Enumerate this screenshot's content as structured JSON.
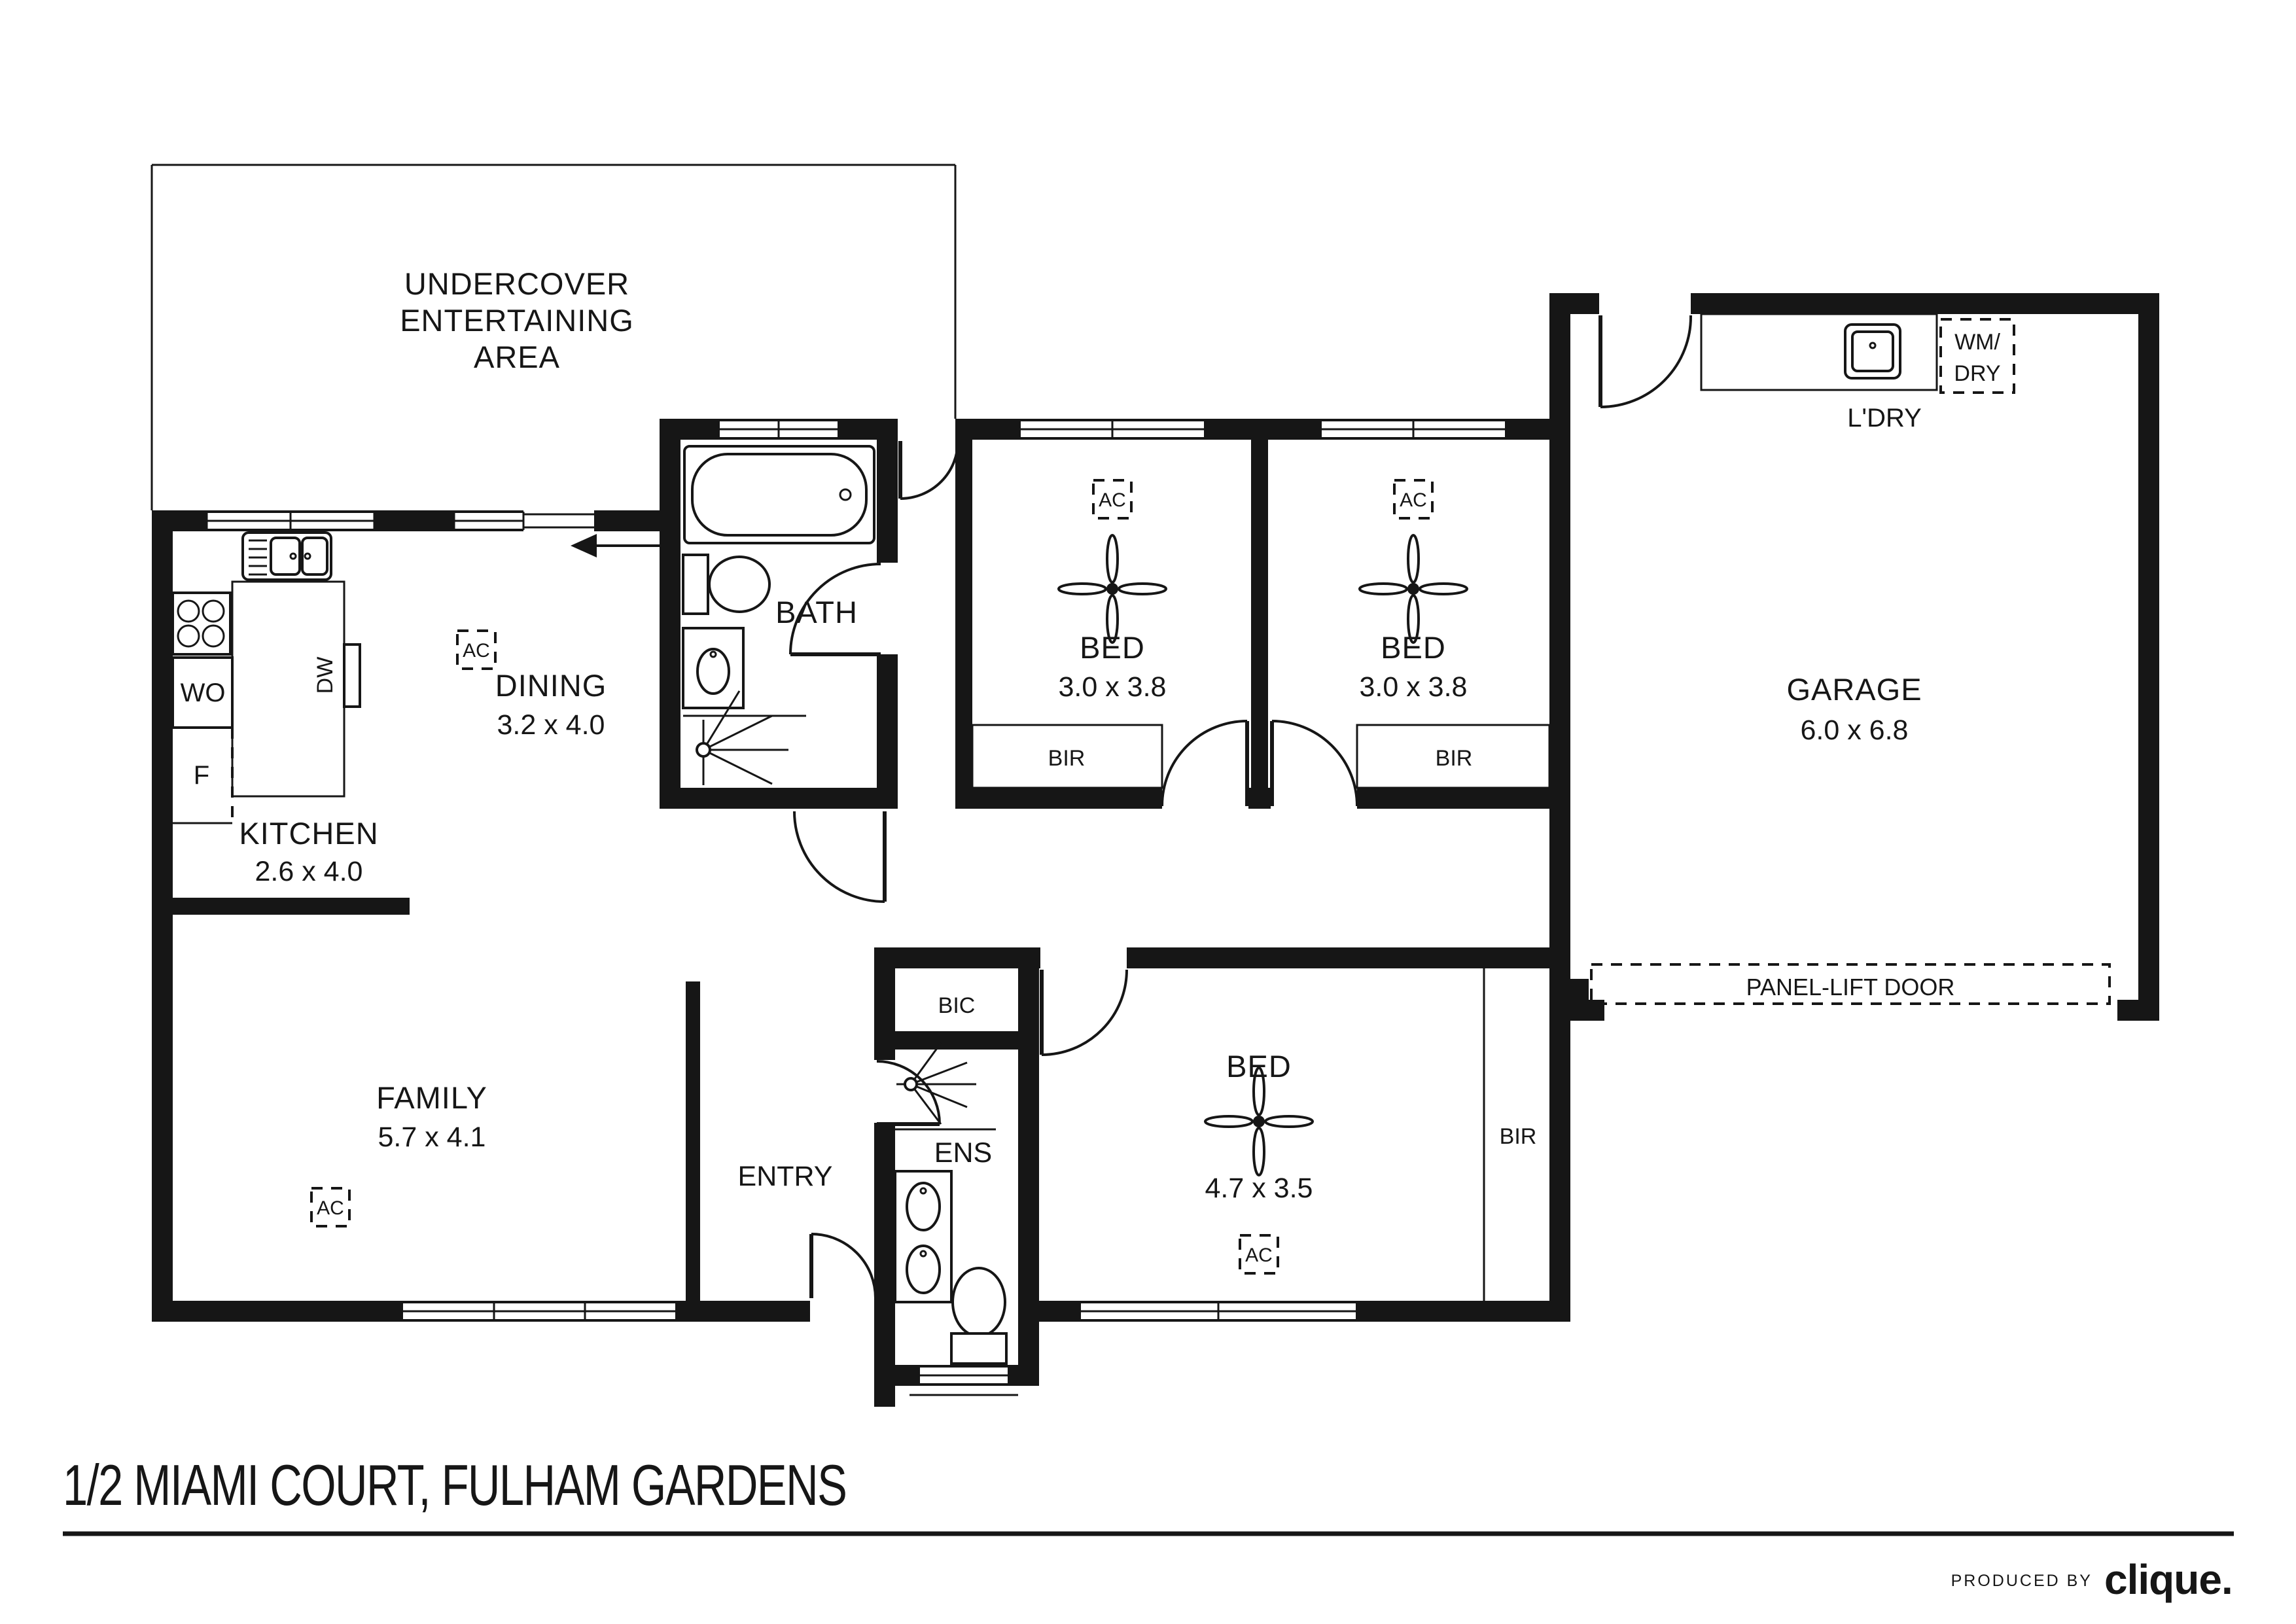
{
  "colors": {
    "ink": "#161616",
    "paper": "#ffffff"
  },
  "title": "1/2 MIAMI COURT, FULHAM GARDENS",
  "footer": {
    "produced_by": "PRODUCED BY",
    "brand": "clique."
  },
  "rooms": {
    "undercover": {
      "line1": "UNDERCOVER",
      "line2": "ENTERTAINING",
      "line3": "AREA"
    },
    "kitchen": {
      "name": "KITCHEN",
      "dims": "2.6 x 4.0"
    },
    "dining": {
      "name": "DINING",
      "dims": "3.2 x 4.0"
    },
    "family": {
      "name": "FAMILY",
      "dims": "5.7 x 4.1"
    },
    "bath": {
      "name": "BATH"
    },
    "entry": {
      "name": "ENTRY"
    },
    "ens": {
      "name": "ENS"
    },
    "bic": {
      "name": "BIC"
    },
    "bed1": {
      "name": "BED",
      "dims": "3.0 x 3.8"
    },
    "bed2": {
      "name": "BED",
      "dims": "3.0 x 3.8"
    },
    "bed3": {
      "name": "BED",
      "dims": "4.7 x 3.5"
    },
    "garage": {
      "name": "GARAGE",
      "dims": "6.0 x 6.8"
    },
    "laundry": {
      "name": "L'DRY"
    }
  },
  "fixtures": {
    "ac": "AC",
    "bir": "BIR",
    "wall_oven": "WO",
    "fridge": "F",
    "dishwasher": "DW",
    "wm_line1": "WM/",
    "wm_line2": "DRY",
    "panel_lift_door": "PANEL-LIFT DOOR"
  }
}
